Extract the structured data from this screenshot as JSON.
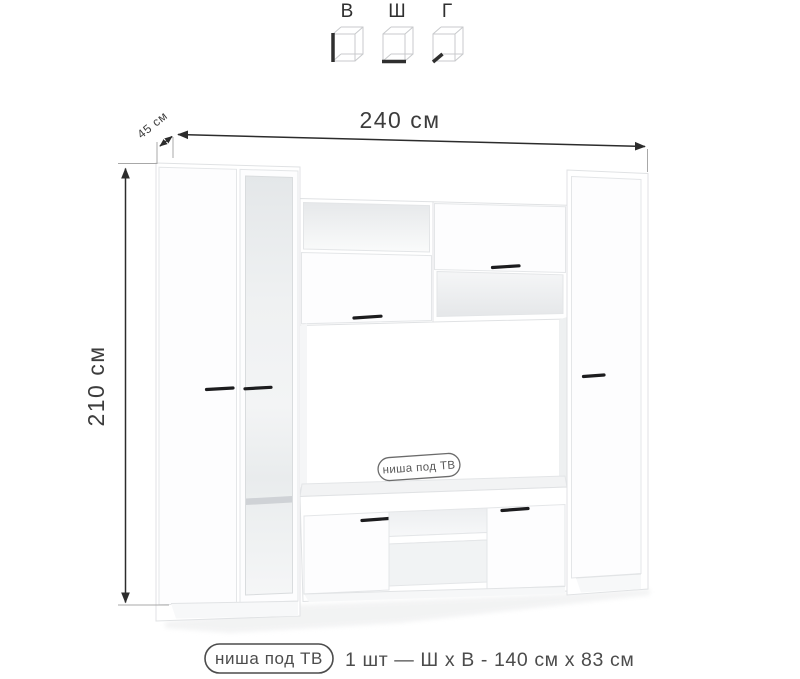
{
  "legend": {
    "cubes": [
      {
        "label": "В",
        "icon": "cube-height-edge-icon"
      },
      {
        "label": "Ш",
        "icon": "cube-width-edge-icon"
      },
      {
        "label": "Г",
        "icon": "cube-depth-edge-icon"
      }
    ]
  },
  "dimensions": {
    "width": "240 см",
    "depth": "45 см",
    "height": "210 см"
  },
  "furniture": {
    "tv_niche_badge": "ниша под ТВ"
  },
  "caption": {
    "badge": "ниша под ТВ",
    "spec": "1 шт — Ш х В - 140 см х 83 см"
  },
  "colors": {
    "text": "#3c3c3c",
    "dimension_line": "#2c2c2c",
    "extension_line": "#a8a8a8",
    "furniture_outline": "#e0e2e4",
    "furniture_fill": "#ffffff",
    "interior_shading": "#e9ebed",
    "handle": "#1c1c1e",
    "badge_border": "#6b6b6b",
    "caption_text": "#4c4c4c"
  }
}
